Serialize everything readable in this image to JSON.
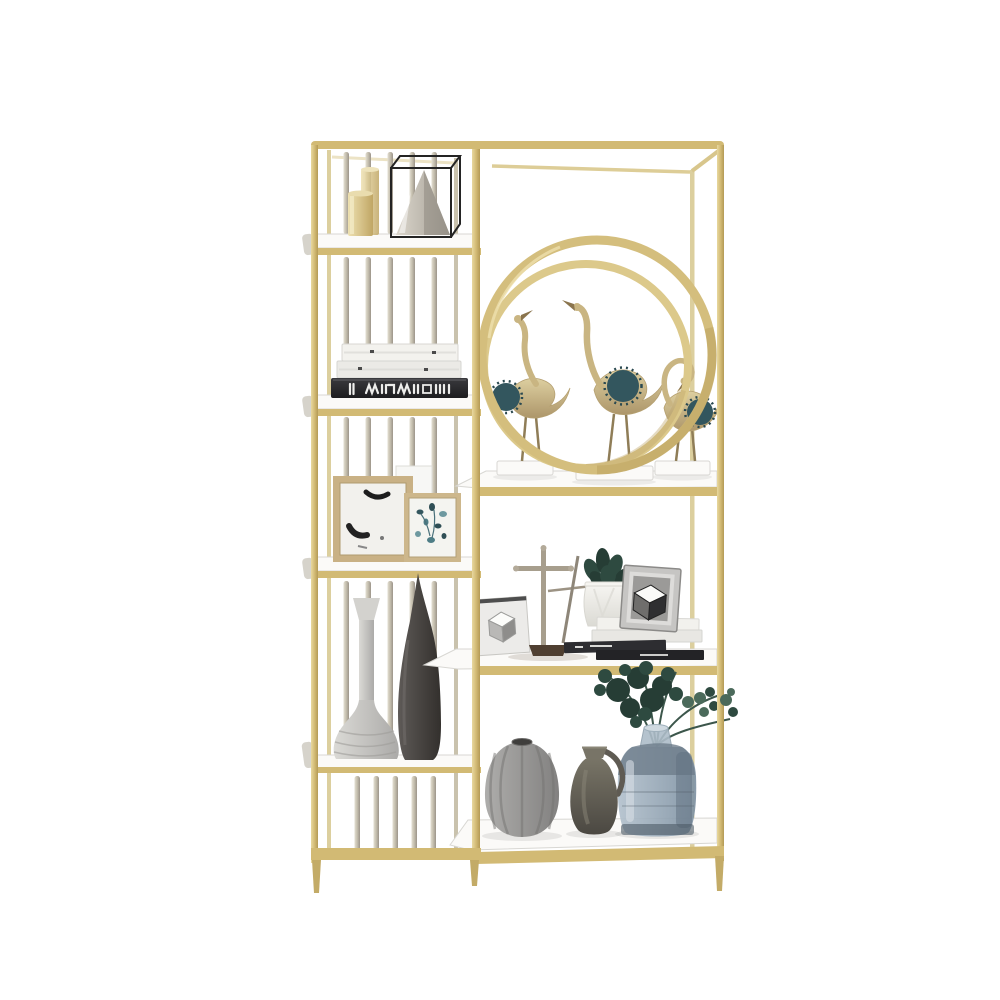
{
  "scene": {
    "type": "product-photo",
    "subject": "gold metal etagere display bookshelf with decor objects",
    "background": "#ffffff",
    "columns": 2,
    "left_column_shelves": 5,
    "right_column_shelves": 3
  },
  "palette": {
    "gold": "#d2ba74",
    "gold_light": "#e6d59c",
    "gold_deep": "#b59e5c",
    "gold_back": "#dccf9e",
    "rod_back": "#c9c2ad",
    "shelf_white": "#fbfaf8",
    "shelf_edge": "#d8d7d3",
    "paper_white": "#f3f2ee",
    "book_black": "#26262a",
    "frame_tan": "#c9b185",
    "art_ink": "#1d1d1d",
    "art_teal": "#4e7d86",
    "vase_light": "#c9c8c4",
    "vase_dark": "#45423f",
    "metal_grey": "#a79e8d",
    "base_brown": "#4f3f31",
    "pot_white": "#efeeea",
    "plant_stem": "#3c564b",
    "plant_dark": "#263d35",
    "plant_mid": "#2e4a40",
    "plant_light": "#4b6a5b",
    "crane_gold": "#c9b582",
    "crane_teal": "#33565e",
    "pumpkin_grey": "#999896",
    "jug_olive": "#66625a",
    "glass_blue": "#9fb0bf",
    "wire_black": "#242424",
    "pyramid_grey": "#a89f93"
  },
  "objects": [
    {
      "name": "gold-canister",
      "shelf": "left-top"
    },
    {
      "name": "glass-box-pyramid",
      "shelf": "left-top"
    },
    {
      "name": "book-stack-left",
      "shelf": "left-2",
      "books": 3
    },
    {
      "name": "photo-frame-large",
      "shelf": "left-3"
    },
    {
      "name": "photo-frame-small",
      "shelf": "left-3"
    },
    {
      "name": "funnel-vase",
      "shelf": "left-4"
    },
    {
      "name": "teardrop-vase",
      "shelf": "left-4"
    },
    {
      "name": "double-ring-ornament",
      "shelf": "right-top"
    },
    {
      "name": "crane-figurines",
      "shelf": "right-top",
      "count": 3
    },
    {
      "name": "cube-art-card",
      "shelf": "right-middle"
    },
    {
      "name": "cross-stand",
      "shelf": "right-middle"
    },
    {
      "name": "succulent-planter",
      "shelf": "right-middle"
    },
    {
      "name": "cube-art-frame",
      "shelf": "right-middle"
    },
    {
      "name": "book-stack-right",
      "shelf": "right-middle",
      "books": 4
    },
    {
      "name": "pumpkin-vase",
      "shelf": "right-bottom"
    },
    {
      "name": "jug-vase",
      "shelf": "right-bottom"
    },
    {
      "name": "glass-vase-eucalyptus",
      "shelf": "right-bottom"
    }
  ]
}
